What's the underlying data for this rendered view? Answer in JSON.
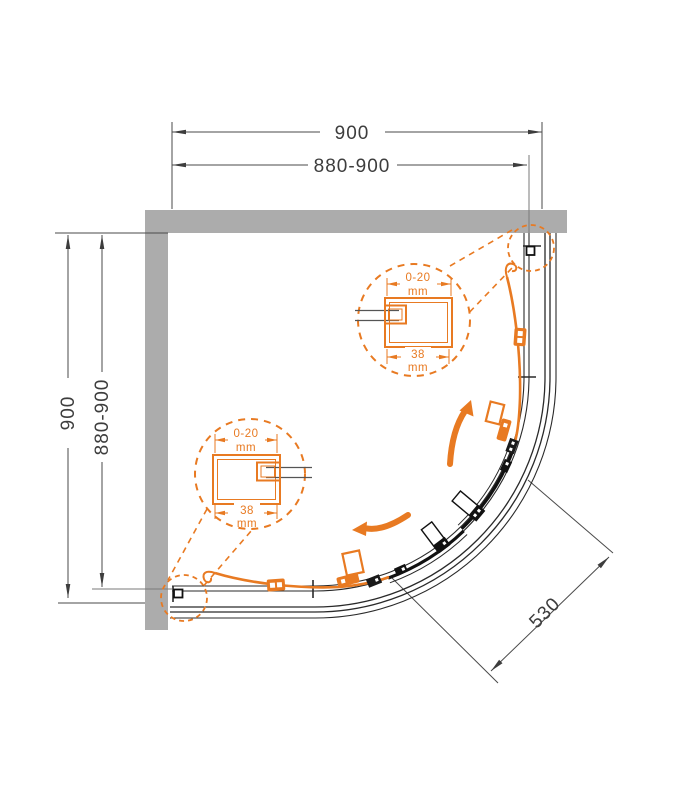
{
  "title": "quadrant-shower-enclosure-plan-drawing",
  "dimensions": {
    "top_outer": "900",
    "top_adjustable": "880-900",
    "left_outer": "900",
    "left_adjustable": "880-900",
    "radius": "530"
  },
  "detail_callout_top": {
    "adjustment_range": "0-20",
    "adjustment_unit": "mm",
    "profile_width": "38",
    "profile_width_unit": "mm"
  },
  "detail_callout_bottom": {
    "adjustment_range": "0-20",
    "adjustment_unit": "mm",
    "profile_width": "38",
    "profile_width_unit": "mm"
  },
  "colors": {
    "accent_orange": "#E87A22",
    "wall_gray": "#ACACAC",
    "drawing_line": "#2A2A2A",
    "dimension_line": "#4A4A4A"
  }
}
